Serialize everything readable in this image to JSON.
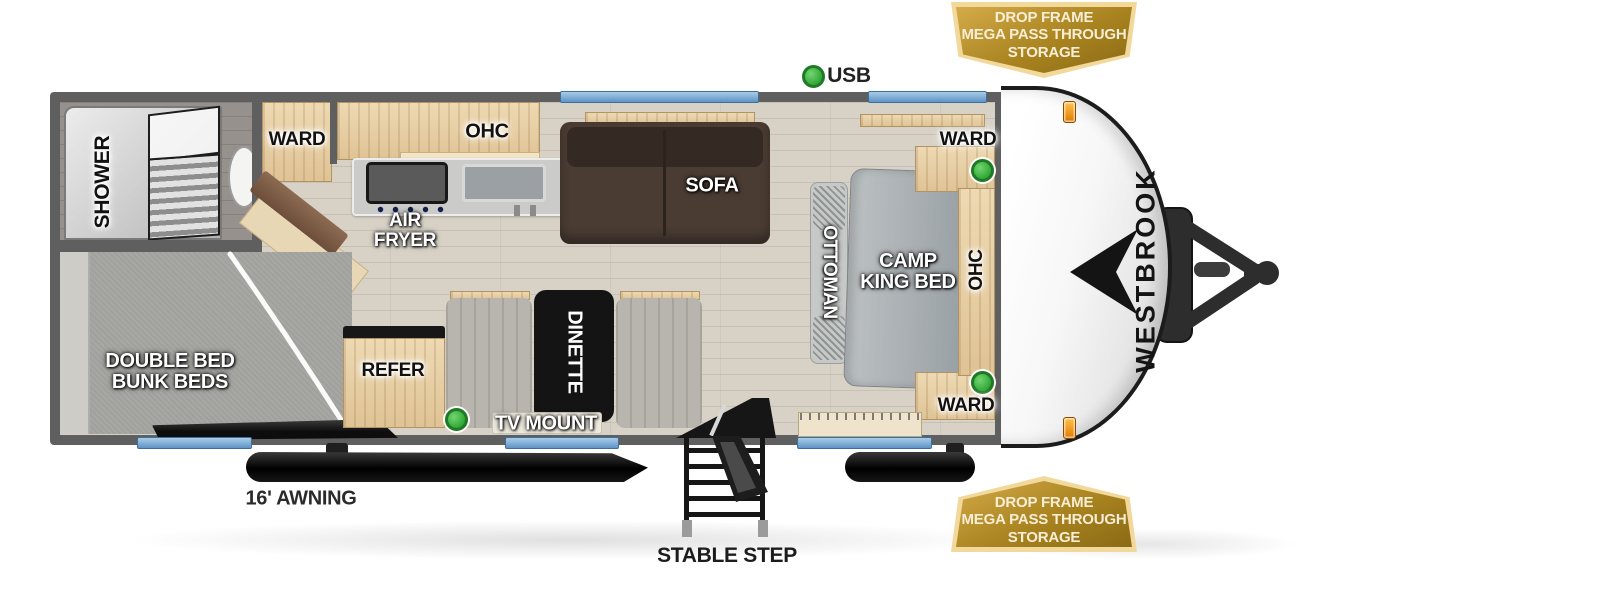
{
  "brand": "WESTBROOK",
  "badge": {
    "line1": "DROP FRAME",
    "line2": "MEGA PASS THROUGH",
    "line3": "STORAGE"
  },
  "legend": {
    "usb": "USB"
  },
  "labels": {
    "shower": "SHOWER",
    "ward": "WARD",
    "ohc": "OHC",
    "air_fryer": "AIR FRYER",
    "sofa": "SOFA",
    "camp_king_bed": "CAMP KING BED",
    "ottoman": "OTTOMAN",
    "bunks": "DOUBLE BED BUNK BEDS",
    "refer": "REFER",
    "dinette": "DINETTE",
    "tv_mount": "TV MOUNT",
    "awning": "16' AWNING",
    "stable_step": "STABLE STEP"
  },
  "colors": {
    "wall": "#5f5f5f",
    "window_blue": "#6fa5d8",
    "usb_green": "#3db63d",
    "badge_gold": "#a8831f",
    "badge_border": "#f2d89a",
    "cap_white": "#f5f5f5"
  }
}
